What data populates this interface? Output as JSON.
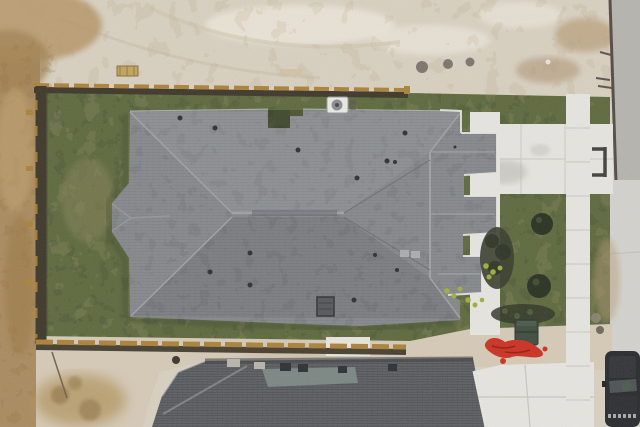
{
  "meta": {
    "type": "aerial-drone-photograph",
    "view": "top-down",
    "subject": "new construction single-family home with sodded fenced yard"
  },
  "palette": {
    "sand": "#d8d0c0",
    "sand_bright": "#ece7db",
    "sand_strip": "#d5cab6",
    "dirt_brown": "#a98a5d",
    "dirt_dark": "#8a6c40",
    "grass": "#5c683c",
    "grass_dark": "#39422a",
    "grass_patch": "#948c5e",
    "roof_main": "#85888c",
    "roof_second": "#5c5f63",
    "flashing": "#7e8b86",
    "concrete": "#e6e5e0",
    "concrete_dim": "#d3d2cd",
    "street": "#b5b3ad",
    "curb": "#4f4a42",
    "fence_dark": "#3c3628",
    "fence_gold": "#aa8138",
    "trim_white": "#e9e7e2",
    "bush": "#27301f",
    "mulch": "#373d2b",
    "plant_yellow": "#9fad3c",
    "bin_green": "#3d4b3d",
    "red_tarp": "#cc2f20",
    "car_body": "#26292c",
    "ac_white": "#e9e9e6"
  },
  "scene": {
    "objects": [
      {
        "name": "graded-dirt-lot",
        "label": "bare tan dirt around the lot"
      },
      {
        "name": "brown-dirt-strip",
        "label": "darker excavated dirt along left edge"
      },
      {
        "name": "lawn",
        "label": "new sod lawn inside fence and front yard"
      },
      {
        "name": "wood-privacy-fence",
        "label": "wood fence on three sides of backyard"
      },
      {
        "name": "main-house-roof",
        "label": "gray architectural shingle hip roof with three front gables"
      },
      {
        "name": "roof-notch",
        "label": "recessed notch in rear roofline"
      },
      {
        "name": "ridge-vent",
        "label": "ridge vent strip on main ridge"
      },
      {
        "name": "roof-vents",
        "label": "small plumbing vents on roof"
      },
      {
        "name": "chimney-vent",
        "label": "rectangular attic vent near lower eave"
      },
      {
        "name": "ac-unit",
        "label": "air conditioner condenser behind house"
      },
      {
        "name": "concrete-driveway",
        "label": "driveway from garage to street"
      },
      {
        "name": "sidewalk",
        "label": "public sidewalk running along street"
      },
      {
        "name": "front-walkway",
        "label": "white porch walk along front of house"
      },
      {
        "name": "street-pavement",
        "label": "asphalt street with curb at right"
      },
      {
        "name": "landscaping-bed",
        "label": "dark mulch beds with shrubs"
      },
      {
        "name": "shrubs",
        "label": "round dark green shrubs in front yard"
      },
      {
        "name": "yellow-plants",
        "label": "small chartreuse plants in beds"
      },
      {
        "name": "trash-bin",
        "label": "dark green trash bin at lot edge"
      },
      {
        "name": "red-tarp",
        "label": "red tarp debris near bin"
      },
      {
        "name": "second-house-roof",
        "label": "darker shingle roof of neighboring house below"
      },
      {
        "name": "neighbor-driveway",
        "label": "neighbor concrete driveway bottom right"
      },
      {
        "name": "parked-vehicle",
        "label": "dark vehicle parked at bottom right"
      },
      {
        "name": "bench-rack",
        "label": "dark metal frame on driveway apron"
      },
      {
        "name": "wood-pallet",
        "label": "pallet and boards on dirt at top"
      },
      {
        "name": "dirt-pile",
        "label": "dirt pile at bottom left"
      }
    ]
  }
}
